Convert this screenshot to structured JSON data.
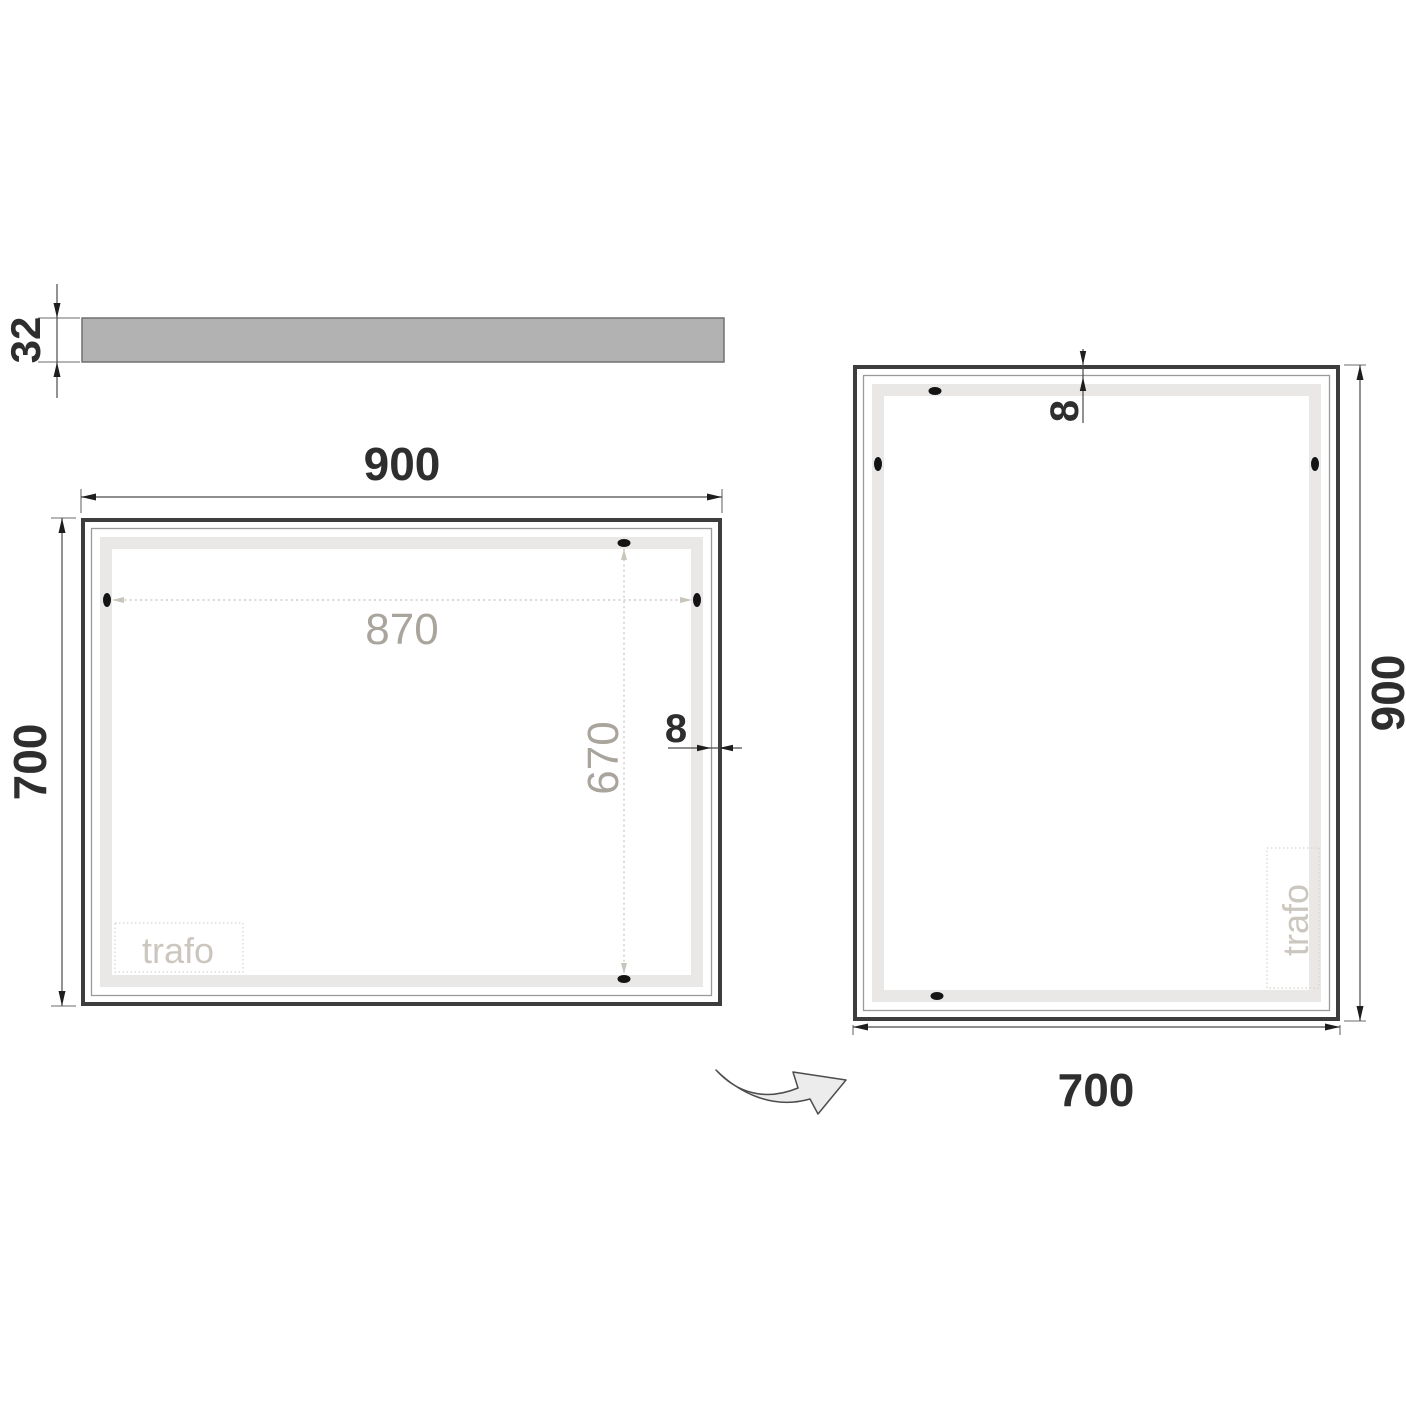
{
  "drawing": {
    "kind": "technical-drawing-led-mirror",
    "side_view": {
      "thickness": "32"
    },
    "landscape_view": {
      "width": "900",
      "height": "700",
      "illuminated_width": "870",
      "illuminated_height": "670",
      "led_offset": "8",
      "transformer": "trafo"
    },
    "portrait_view": {
      "width": "700",
      "height": "900",
      "led_offset": "8",
      "transformer": "trafo"
    },
    "colors": {
      "frame": "#3d3d3d",
      "led_band": "#e9e8e6",
      "profile_bar_fill": "#b2b2b2",
      "dimension_text": "#2e2e2e",
      "light_dimension_text": "#a9a59d",
      "transformer_text": "#cbc7bf",
      "dotted_line": "#cfcbc3",
      "rotation_arrow_fill": "#ececec"
    }
  }
}
